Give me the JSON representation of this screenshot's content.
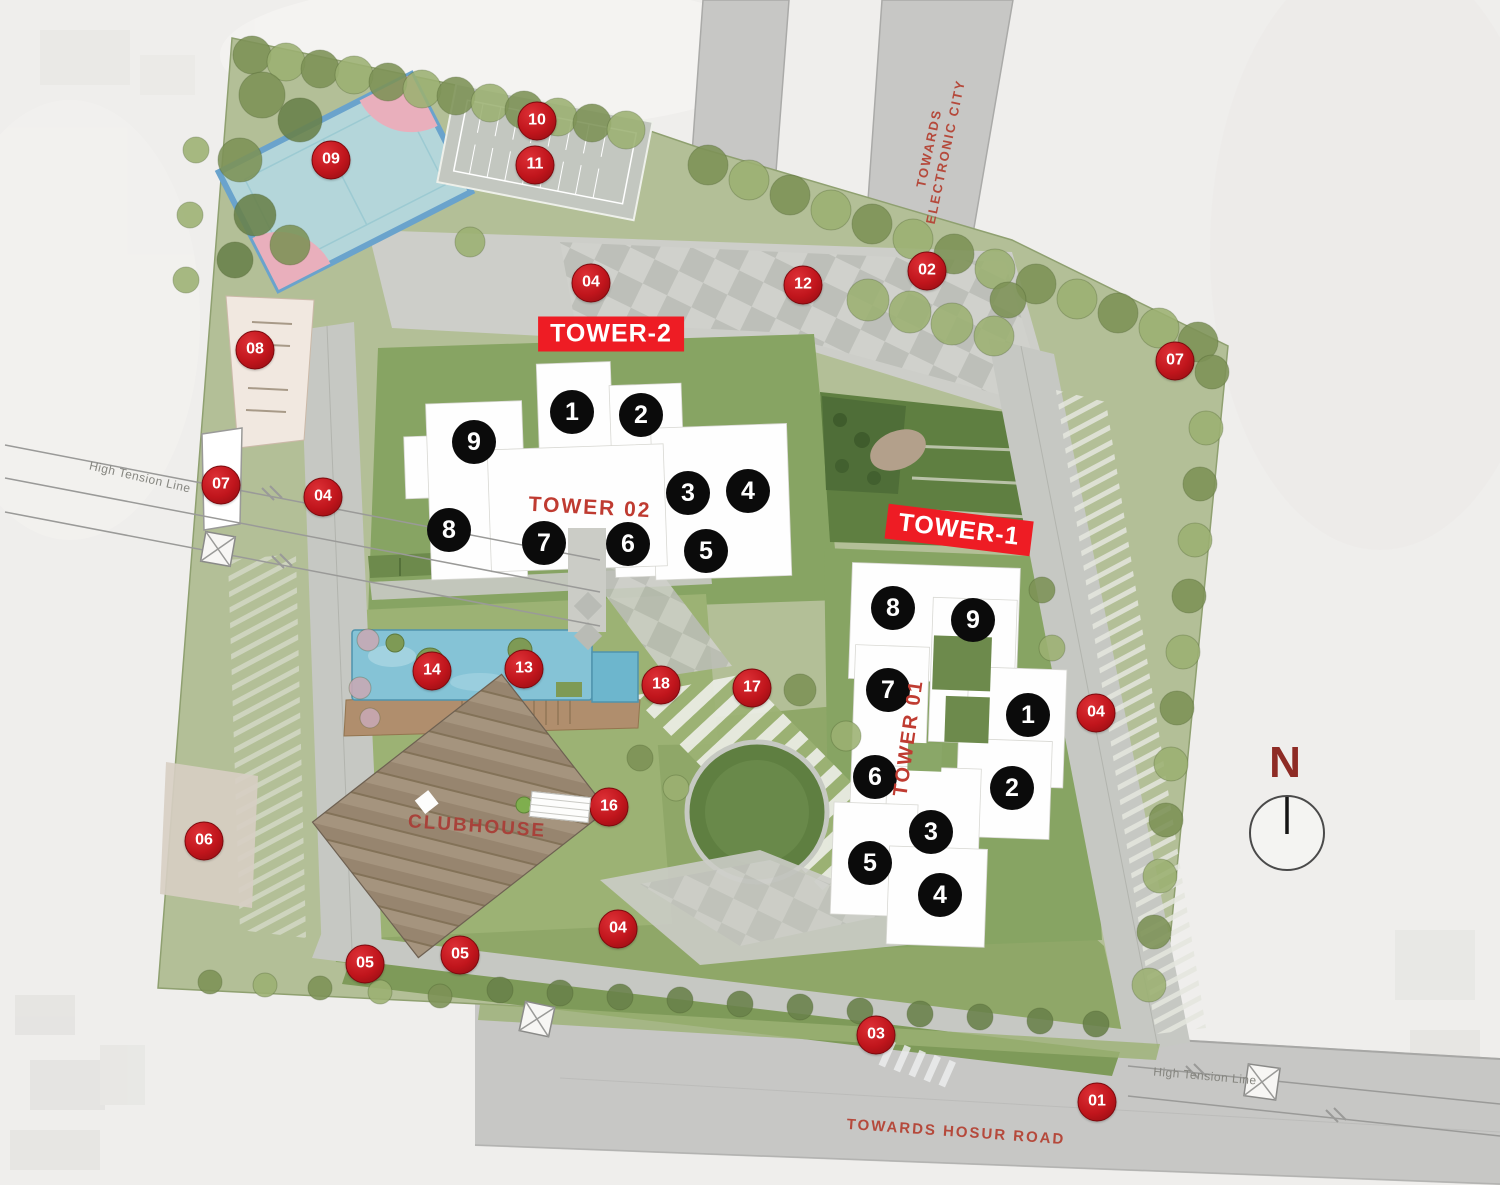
{
  "compass": {
    "label": "N"
  },
  "roads": {
    "electronic_line1": "TOWARDS",
    "electronic_line2": "ELECTRONIC CITY",
    "hosur": "TOWARDS HOSUR ROAD"
  },
  "power": {
    "left_label": "High Tension Line",
    "bottom_label": "High Tension Line"
  },
  "clubhouse": {
    "label": "CLUBHOUSE"
  },
  "tower2": {
    "banner": "TOWER-2",
    "name": "TOWER 02",
    "units": [
      {
        "n": "1",
        "x": 572,
        "y": 412
      },
      {
        "n": "2",
        "x": 641,
        "y": 415
      },
      {
        "n": "3",
        "x": 688,
        "y": 493
      },
      {
        "n": "4",
        "x": 748,
        "y": 491
      },
      {
        "n": "5",
        "x": 706,
        "y": 551
      },
      {
        "n": "6",
        "x": 628,
        "y": 544
      },
      {
        "n": "7",
        "x": 544,
        "y": 543
      },
      {
        "n": "8",
        "x": 449,
        "y": 530
      },
      {
        "n": "9",
        "x": 474,
        "y": 442
      }
    ]
  },
  "tower1": {
    "banner": "TOWER-1",
    "name": "TOWER 01",
    "units": [
      {
        "n": "1",
        "x": 1028,
        "y": 715
      },
      {
        "n": "2",
        "x": 1012,
        "y": 788
      },
      {
        "n": "3",
        "x": 931,
        "y": 832
      },
      {
        "n": "4",
        "x": 940,
        "y": 895
      },
      {
        "n": "5",
        "x": 870,
        "y": 863
      },
      {
        "n": "6",
        "x": 875,
        "y": 777
      },
      {
        "n": "7",
        "x": 888,
        "y": 690
      },
      {
        "n": "8",
        "x": 893,
        "y": 608
      },
      {
        "n": "9",
        "x": 973,
        "y": 620
      }
    ]
  },
  "badges": [
    {
      "label": "10",
      "x": 537,
      "y": 121
    },
    {
      "label": "11",
      "x": 535,
      "y": 165
    },
    {
      "label": "09",
      "x": 331,
      "y": 160
    },
    {
      "label": "04",
      "x": 591,
      "y": 283
    },
    {
      "label": "12",
      "x": 803,
      "y": 285
    },
    {
      "label": "02",
      "x": 927,
      "y": 271
    },
    {
      "label": "07",
      "x": 1175,
      "y": 361
    },
    {
      "label": "08",
      "x": 255,
      "y": 350
    },
    {
      "label": "07",
      "x": 221,
      "y": 485
    },
    {
      "label": "04",
      "x": 323,
      "y": 497
    },
    {
      "label": "04",
      "x": 1096,
      "y": 713
    },
    {
      "label": "14",
      "x": 432,
      "y": 671
    },
    {
      "label": "13",
      "x": 524,
      "y": 669
    },
    {
      "label": "18",
      "x": 661,
      "y": 685
    },
    {
      "label": "17",
      "x": 752,
      "y": 688
    },
    {
      "label": "16",
      "x": 609,
      "y": 807
    },
    {
      "label": "06",
      "x": 204,
      "y": 841
    },
    {
      "label": "05",
      "x": 365,
      "y": 964
    },
    {
      "label": "05",
      "x": 460,
      "y": 955
    },
    {
      "label": "04",
      "x": 618,
      "y": 929
    },
    {
      "label": "03",
      "x": 876,
      "y": 1035
    },
    {
      "label": "01",
      "x": 1097,
      "y": 1102
    }
  ],
  "colors": {
    "badge_red": "#c0151c",
    "banner_red": "#ee1c24",
    "tower_text": "#bf3b31",
    "road_text": "#b5493b",
    "pool_blue": "#85c3d6",
    "court_blue": "#b4d6da",
    "court_pink": "#e9afbc"
  }
}
